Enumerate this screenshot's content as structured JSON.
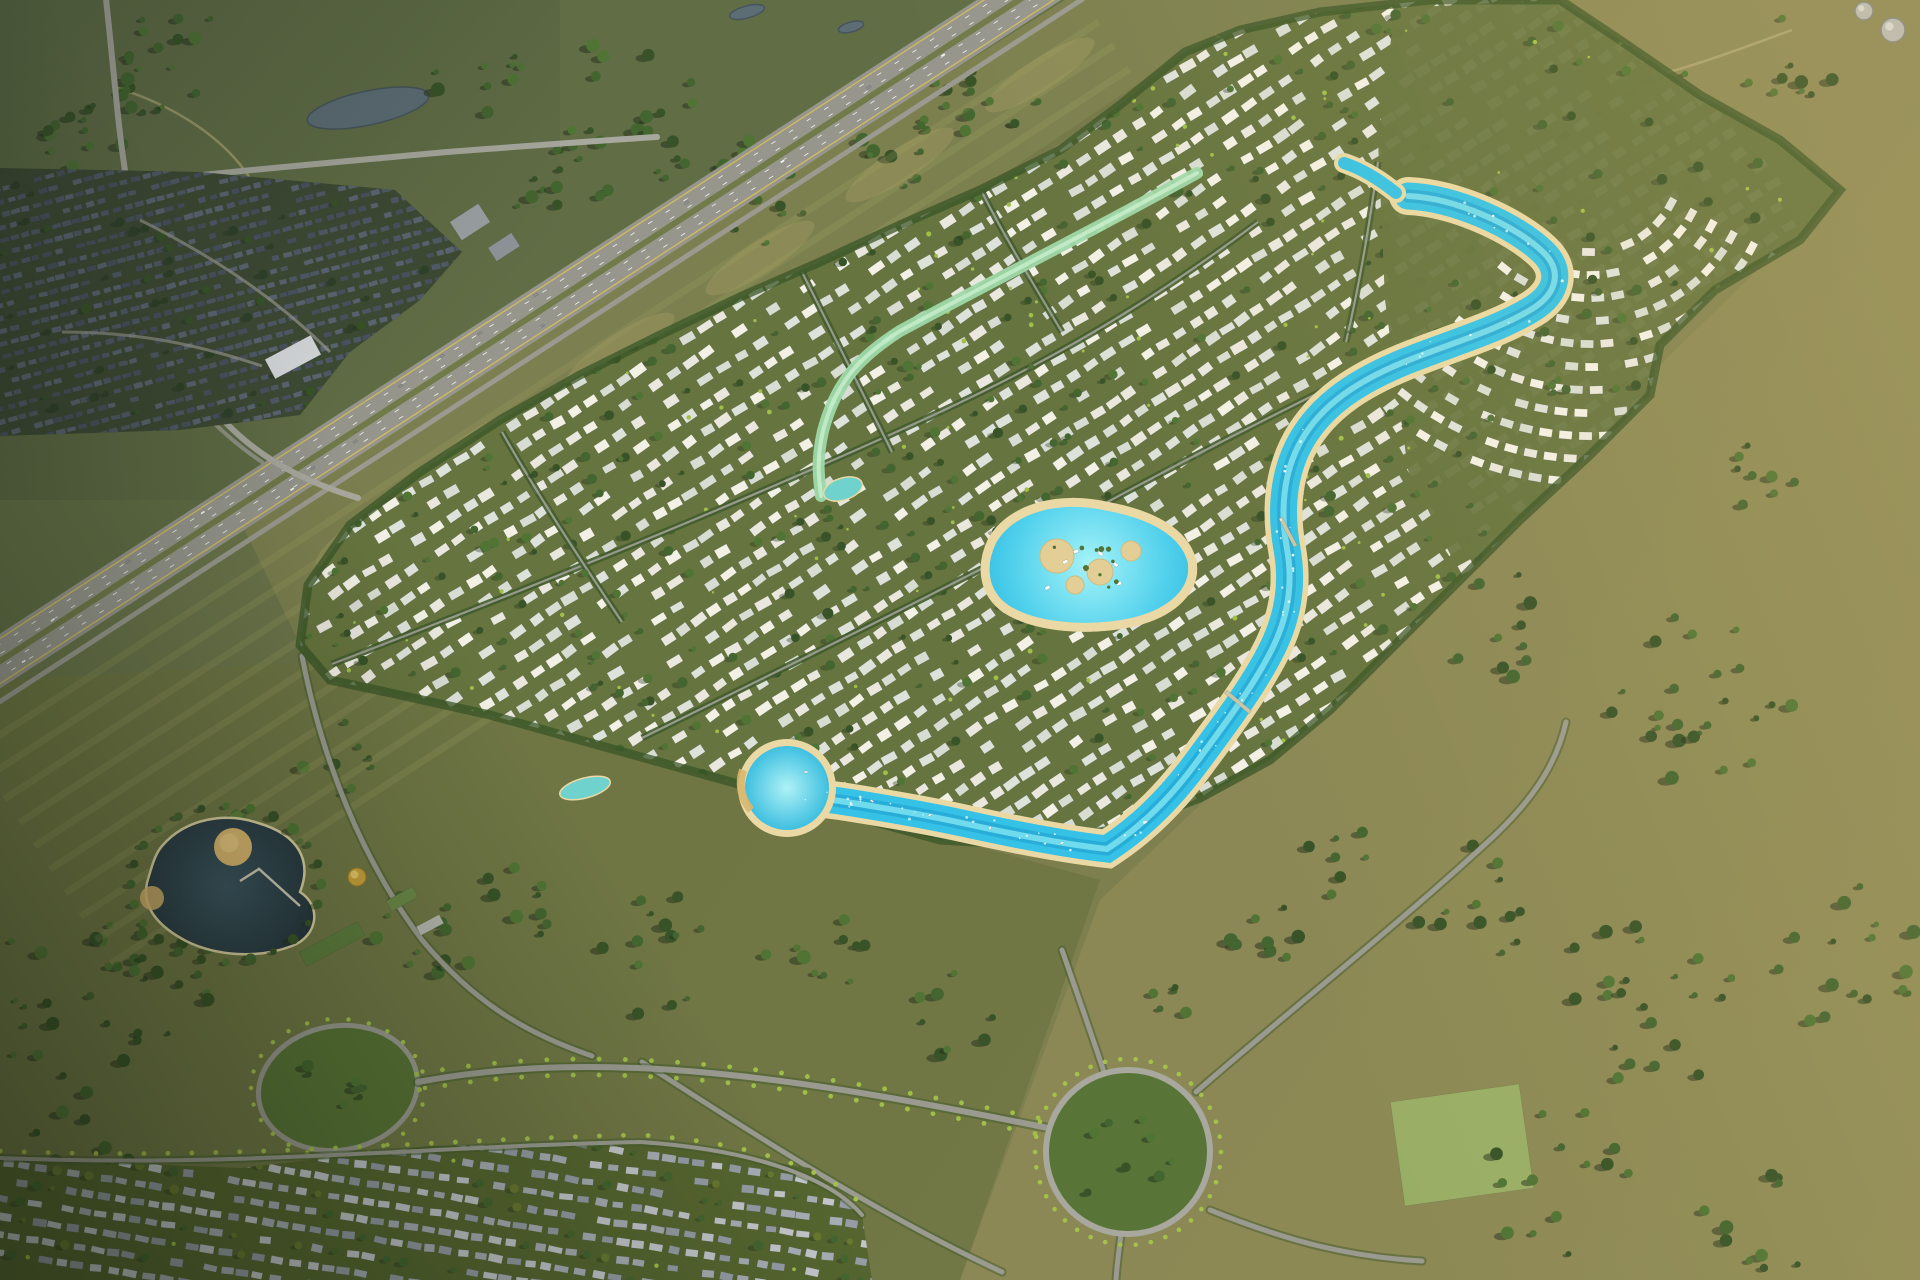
{
  "meta": {
    "width": 1920,
    "height": 1280,
    "description": "Aerial render of a lagoon master-planned villa community surrounded by grassland, a diagonal highway and neighboring suburbs"
  },
  "palette": {
    "fieldBase": "#75794a",
    "fieldTopLeft": "#5f6d45",
    "fieldStrip": "#7d8150",
    "fieldRight": "#8d8a56",
    "fieldBottom": "#6f7643",
    "mowLine": "#a3a465",
    "dirtTrack": "#b3ab77",
    "tanPatch": "#a59b63",
    "highway": "#96968d",
    "roadLight": "#a8a89e",
    "roadMid": "#9a9a90",
    "median": "#717a49",
    "laneYellow": "#d6c05a",
    "carWhite": "#f2f2ee",
    "treeShadow": "#23301b",
    "tree1": "#375327",
    "tree2": "#43652f",
    "tree3": "#4f7434",
    "treeLight": "#7fa03f",
    "palm": "#9fbf48",
    "devBase": "#66743f",
    "houseWhite": "#eae8de",
    "house2": "#dde2da",
    "house3": "#f3f1e6",
    "house4": "#d8ddd3",
    "roadCaseGreen": "#415c2c",
    "suburbBase": "#3d4a33",
    "suburbRoof1": "#515b68",
    "suburbRoof2": "#5c6673",
    "suburbRoof3": "#49525f",
    "suburbTree": "#2e4128",
    "commBase": "#55652f",
    "commRoof1": "#a7adb3",
    "commRoof2": "#c2c6ca",
    "commRoof3": "#959ca4",
    "commTree": "#67782f",
    "commPalm": "#a4c24b",
    "sand": "#ead9a4",
    "sandDark": "#d9b66e",
    "lagoon": "#35c2e6",
    "lagoonDeep": "#1f9fd0",
    "lagoonLight": "#8feef5",
    "mint": "#9fd8a8",
    "mintPond": "#6fd2cc",
    "pondDark": "#25343c",
    "pondMid": "#32464f",
    "gold": "#c9a23c",
    "goldLight": "#e7c766",
    "pondGray": "#5d6d75",
    "white": "#ffffff"
  },
  "scene": {
    "seed": 11,
    "fields": {
      "topLeft": "0,0 1065,0 240,520 0,680",
      "strip": "1065,0 1430,0 1185,52 980,190 660,335 400,695 300,645 240,520",
      "right": "1430,0 1920,0 1920,1280 960,1280 1100,900 1500,520 1840,190",
      "bottom": "0,680 350,660 700,770 1100,880 960,1280 0,1280",
      "stripPatches": [
        [
          1040,
          75
        ],
        [
          900,
          165
        ],
        [
          760,
          258
        ],
        [
          620,
          350
        ],
        [
          480,
          445
        ],
        [
          370,
          530
        ]
      ]
    },
    "patches": [
      {
        "x": 1462,
        "y": 1145,
        "w": 130,
        "h": 105,
        "rot": -8,
        "fill": "#9db86a"
      }
    ],
    "fieldPonds": [
      {
        "cx": 368,
        "cy": 108,
        "rx": 62,
        "ry": 17,
        "rot": -12
      },
      {
        "cx": 747,
        "cy": 12,
        "rx": 18,
        "ry": 6,
        "rot": -15
      },
      {
        "cx": 851,
        "cy": 27,
        "rx": 13,
        "ry": 5,
        "rot": -15
      },
      {
        "cx": 1258,
        "cy": 100,
        "rx": 16,
        "ry": 6,
        "rot": -10
      }
    ],
    "tracks": [
      "M1215,35 C1330,95 1432,105 1545,95 C1652,85 1722,55 1792,30",
      "M118,88 C180,108 225,140 250,178"
    ],
    "treeClusters": [
      [
        180,
        60,
        70,
        22
      ],
      [
        90,
        150,
        55,
        14
      ],
      [
        615,
        120,
        85,
        22
      ],
      [
        760,
        185,
        60,
        14
      ],
      [
        975,
        95,
        65,
        15
      ],
      [
        1120,
        195,
        50,
        10
      ],
      [
        1650,
        118,
        60,
        12
      ],
      [
        1790,
        60,
        50,
        9
      ],
      [
        1500,
        625,
        55,
        10
      ],
      [
        1700,
        700,
        95,
        24
      ],
      [
        1770,
        480,
        45,
        8
      ],
      [
        1850,
        960,
        75,
        16
      ],
      [
        1640,
        1000,
        95,
        22
      ],
      [
        1470,
        905,
        60,
        12
      ],
      [
        1270,
        950,
        45,
        8
      ],
      [
        1560,
        1180,
        75,
        14
      ],
      [
        1760,
        1220,
        60,
        10
      ],
      [
        80,
        1000,
        95,
        26
      ],
      [
        190,
        950,
        60,
        14
      ],
      [
        60,
        1180,
        85,
        20
      ],
      [
        420,
        945,
        55,
        12
      ],
      [
        530,
        900,
        50,
        9
      ],
      [
        645,
        950,
        65,
        13
      ],
      [
        820,
        962,
        55,
        10
      ],
      [
        950,
        1012,
        45,
        8
      ],
      [
        255,
        862,
        50,
        10
      ],
      [
        450,
        585,
        40,
        8
      ],
      [
        340,
        760,
        40,
        8
      ],
      [
        1340,
        862,
        40,
        7
      ],
      [
        1180,
        998,
        32,
        5
      ],
      [
        560,
        180,
        50,
        10
      ],
      [
        480,
        80,
        45,
        9
      ],
      [
        900,
        150,
        40,
        8
      ]
    ],
    "highway": {
      "path": "M1065,-30 L-60,700",
      "width": 46,
      "frontageOffset": 34,
      "edgeOffset": 19,
      "laneOffsets": [
        -14,
        -6,
        6,
        14
      ],
      "mowOffsets": [
        62,
        90,
        118,
        146,
        174,
        202,
        230,
        258,
        286,
        314
      ],
      "carCount": 16
    },
    "localRoads": [
      "M105,-10 C115,80 118,130 127,183 C136,262 158,330 205,398 C242,448 292,478 358,498",
      "M0,200 C60,195 95,188 127,183 C262,168 362,160 447,152 C527,146 577,142 657,137",
      "M140,220 C220,260 280,302 330,352",
      "M62,332 C142,332 202,346 262,366",
      "M152,347 C182,392 217,432 262,462"
    ],
    "southRoads": [
      "M302,656 C322,760 362,860 422,940 C472,1000 522,1032 592,1056",
      "M1104,1072 C1090,1030 1076,990 1062,950",
      "M1196,1092 C1290,1010 1392,930 1492,838 C1538,795 1558,758 1566,722",
      "M1210,1210 C1292,1243 1352,1257 1422,1261",
      "M1121,1234 C1119,1250 1117,1264 1116,1280",
      "M642,1062 C762,1140 882,1216 1002,1272"
    ],
    "avenue": "M418,1082 C610,1046 810,1080 1048,1128",
    "suburb": {
      "clip": "0,168 200,172 395,190 462,252 420,300 350,352 300,415 180,430 0,436",
      "houses": {
        "cx": 225,
        "cy": 300,
        "angle": -15,
        "row": 12.5,
        "step": 11,
        "w": 8.2,
        "h": 5,
        "uExt": 300,
        "vExt": 165,
        "skip": 0.16,
        "jitter": 8,
        "colors": [
          "suburbRoof1",
          "suburbRoof2",
          "suburbRoof3"
        ],
        "treeChance": 0.5,
        "treeColors": [
          "suburbTree",
          "tree1"
        ],
        "palmChance": 0
      }
    },
    "development": {
      "clip": "1185,52 1240,30 1320,12 1430,0 1560,0 1620,40 1700,95 1780,140 1840,190 1800,240 1715,290 1660,345 1650,395 1590,455 1520,520 1450,590 1390,650 1330,710 1270,760 1200,798 1120,828 1030,845 940,840 850,815 760,790 670,765 580,740 490,715 400,695 330,680 300,645 308,585 350,525 420,472 500,420 580,375 660,335 740,297 820,262 900,225 980,190 1060,150 1120,105",
      "houses": {
        "cx": 950,
        "cy": 430,
        "angle": -33,
        "row": 22,
        "step": 20,
        "w": 13.5,
        "h": 8.5,
        "uExt": 830,
        "vExt": 440,
        "skip": 0.2,
        "jitter": 10,
        "colors": [
          "houseWhite",
          "house2",
          "house3",
          "house4"
        ],
        "treeChance": 0.6,
        "treeColors": [
          "tree1",
          "tree2",
          "tree3"
        ],
        "palmChance": 0.12
      },
      "arcRows": {
        "cx": 1590,
        "cy": 160,
        "r0": 92,
        "r1": 338,
        "dr": 23,
        "t0": 0.5,
        "t1": 2.3,
        "step": 20,
        "cover": "1395,8 1560,0 1620,40 1700,95 1780,140 1840,190 1800,240 1715,290 1660,345 1650,395 1590,455 1520,520 1452,558 1408,470 1385,300 1378,140"
      },
      "treeCount": 330,
      "palmCount": 150,
      "spines": [
        "M332,664 C520,592 720,512 905,428 C1055,361 1155,299 1258,222",
        "M642,738 C800,660 952,586 1082,516 C1182,461 1262,421 1342,381",
        "M982,192 C1002,232 1032,282 1062,332",
        "M802,272 C832,332 862,392 892,452",
        "M502,432 C542,502 582,562 622,622",
        "M1378,162 C1370,222 1360,282 1346,342"
      ]
    },
    "ribbon": {
      "path": "M1197,173 C1100,227 1000,277 900,331 C861,356 836,381 823,431 C816,462 819,478 821,496",
      "pond": {
        "cx": 843,
        "cy": 489,
        "rx": 20,
        "ry": 11,
        "rot": -18
      },
      "west": {
        "cx": 585,
        "cy": 788,
        "rx": 26,
        "ry": 10,
        "rot": -15
      }
    },
    "lagoon": {
      "main": "M1408,196 C1455,198 1515,225 1543,252 C1562,270 1558,293 1532,309 C1496,331 1448,344 1404,362 C1358,381 1322,404 1301,441 C1283,473 1280,511 1287,549 C1293,582 1289,614 1273,647 C1256,682 1228,720 1196,763 C1171,797 1141,827 1107,849 C1062,844 1012,834 962,823 C921,814 872,806 840,801 C817,798 801,796 789,791",
      "tail": "M1344,163 C1362,169 1380,180 1396,193",
      "central": "M992,541 C1012,506 1062,496 1106,506 C1150,514 1184,531 1192,561 C1197,589 1174,612 1134,622 C1089,632 1036,628 1006,609 C983,593 980,566 992,541 Z",
      "basin": {
        "cx": 787,
        "cy": 788,
        "r": 42
      },
      "islands": [
        [
          1057,
          556,
          17
        ],
        [
          1100,
          572,
          13
        ],
        [
          1131,
          551,
          10
        ],
        [
          1075,
          585,
          9
        ]
      ],
      "bridges": [
        {
          "x": 1288,
          "y": 532,
          "rot": 62
        },
        {
          "x": 1238,
          "y": 702,
          "rot": 40
        }
      ],
      "boats": [
        [
          930,
          815
        ],
        [
          990,
          828
        ],
        [
          1062,
          843
        ],
        [
          872,
          801
        ],
        [
          806,
          772
        ],
        [
          1146,
          822
        ]
      ],
      "sparkleCount": 70
    },
    "leftLake": {
      "path": "M162,846 C186,818 226,812 258,823 C300,835 312,862 300,892 C322,906 318,936 292,946 C258,959 216,956 186,941 C152,923 140,901 149,876 C153,862 156,853 162,846 Z",
      "sandCircle": [
        233,
        847,
        19
      ],
      "sandPatch": [
        152,
        898,
        12
      ],
      "piers": [
        [
          258,
          868,
          300,
          906
        ],
        [
          240,
          881,
          259,
          869
        ]
      ],
      "treeRing": 24
    },
    "amenities": {
      "dome": [
        357,
        877
      ],
      "buildings": [
        {
          "x": 332,
          "y": 944,
          "w": 66,
          "h": 16,
          "rot": -28,
          "fill": "#5d7c3e"
        },
        {
          "x": 402,
          "y": 899,
          "w": 30,
          "h": 12,
          "rot": -28,
          "fill": "#6a8747"
        },
        {
          "x": 430,
          "y": 925,
          "w": 26,
          "h": 10,
          "rot": -28,
          "fill": "#b5b7ae"
        }
      ]
    },
    "buildings": [
      {
        "x": 1597,
        "y": 60,
        "w": 48,
        "h": 18,
        "rot": -28,
        "fill": "#dfe2dd"
      },
      {
        "x": 1306,
        "y": 49,
        "w": 40,
        "h": 15,
        "rot": -30,
        "fill": "#dde0da"
      },
      {
        "x": 470,
        "y": 222,
        "w": 34,
        "h": 22,
        "rot": -33,
        "fill": "#9aa0a2"
      },
      {
        "x": 504,
        "y": 247,
        "w": 28,
        "h": 16,
        "rot": -33,
        "fill": "#8d9396"
      },
      {
        "x": 293,
        "y": 357,
        "w": 52,
        "h": 22,
        "rot": -28,
        "fill": "#d7dadc"
      },
      {
        "x": 1168,
        "y": 370,
        "w": 34,
        "h": 14,
        "rot": -30,
        "fill": "#cfd4cf"
      }
    ],
    "tanks": [
      {
        "cx": 1893,
        "cy": 30,
        "r": 12
      },
      {
        "cx": 1864,
        "cy": 11,
        "r": 9
      }
    ],
    "ovalPark": {
      "cx": 338,
      "cy": 1088,
      "rx": 80,
      "ry": 62,
      "rot": -10
    },
    "roundabout": {
      "cx": 1128,
      "cy": 1152,
      "r": 82
    },
    "community": {
      "clip": "0,1158 240,1168 430,1146 640,1142 810,1168 862,1215 872,1280 0,1280",
      "topRoad": "M0,1158 C240,1168 430,1146 640,1142 C760,1150 832,1180 862,1215",
      "houses": {
        "cx": 420,
        "cy": 1212,
        "angle": 9,
        "row": 18,
        "step": 17,
        "w": 12,
        "h": 7,
        "uExt": 500,
        "vExt": 110,
        "skip": 0.22,
        "jitter": 9,
        "colors": [
          "commRoof1",
          "commRoof2",
          "commRoof3"
        ],
        "treeChance": 0.65,
        "treeColors": [
          "commTree",
          "tree2"
        ],
        "palmChance": 0.2
      }
    }
  }
}
